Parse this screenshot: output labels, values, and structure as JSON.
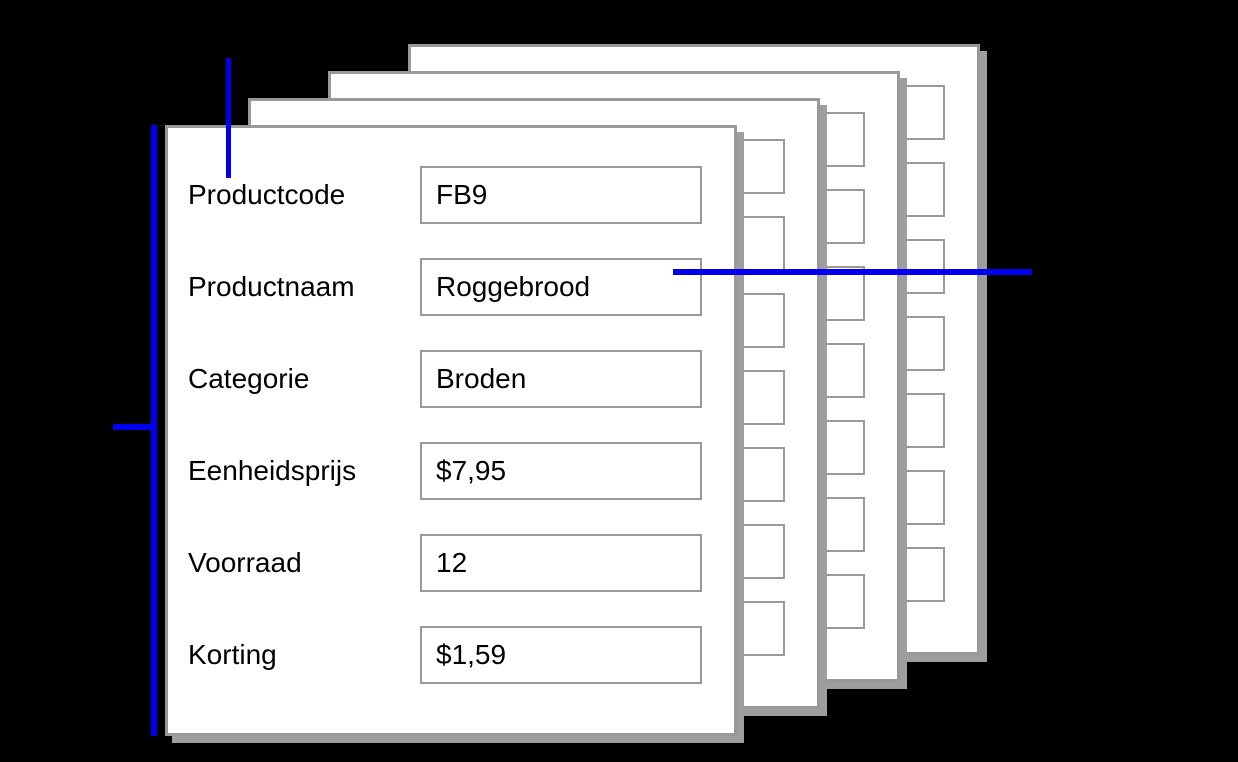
{
  "diagram": {
    "form": {
      "fields": [
        {
          "label": "Productcode",
          "value": "FB9"
        },
        {
          "label": "Productnaam",
          "value": "Roggebrood"
        },
        {
          "label": "Categorie",
          "value": "Broden"
        },
        {
          "label": "Eenheidsprijs",
          "value": "$7,95"
        },
        {
          "label": "Voorraad",
          "value": "12"
        },
        {
          "label": "Korting",
          "value": "$1,59"
        }
      ]
    },
    "background_cards": {
      "count": 3,
      "empty_field_boxes_per_card": 7
    },
    "colors": {
      "background": "#000000",
      "card_fill": "#ffffff",
      "card_border": "#999999",
      "card_shadow": "#9e9e9e",
      "field_border": "#999999",
      "annotation_line": "#0000ee",
      "text": "#000000"
    }
  }
}
